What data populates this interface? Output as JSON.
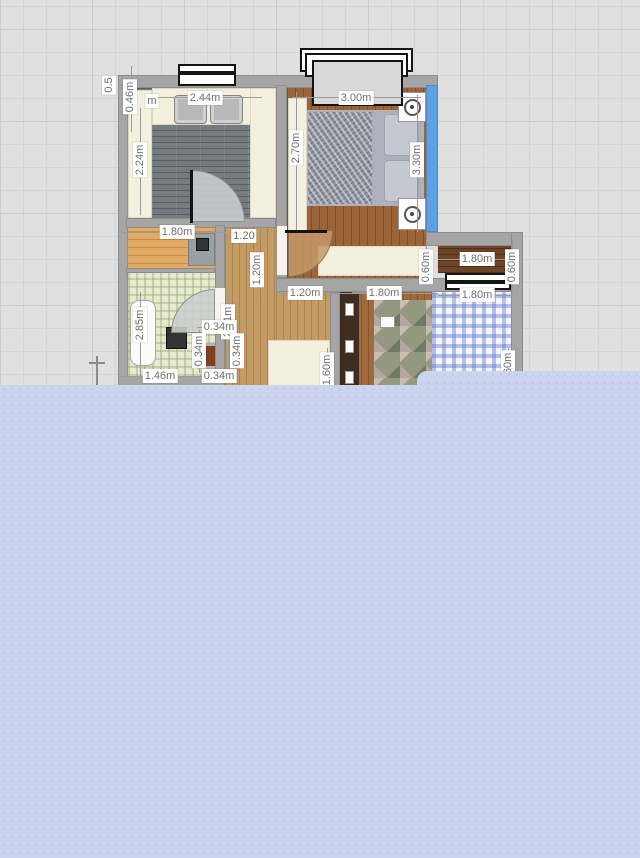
{
  "app": {
    "name": "floor-plan-editor",
    "view": "2d-plan"
  },
  "palette": {
    "canvas_bg": "#e0e0e0",
    "grid_line": "#d4d4d4",
    "grid_major": "#c9cbce",
    "wall": "#a5a5a5",
    "accent_wall_blue": "#5f9fe3",
    "panel": "#cbd5ee",
    "panel_dot": "#c0cae8",
    "dim_text": "#6f6f6f",
    "dim_bg": "#ffffff"
  },
  "panel": {
    "main": {
      "x": 0,
      "y": 385,
      "w": 640,
      "h": 473
    },
    "step": {
      "x": 417,
      "y": 371,
      "w": 223,
      "h": 16
    }
  },
  "plan": {
    "elements": [
      {
        "name": "kitchen-floor",
        "cls": "floor-kitchen",
        "x": 128,
        "y": 88,
        "w": 148,
        "h": 130,
        "ia": 1
      },
      {
        "name": "bedroom-floor",
        "cls": "floor-wood-dark",
        "x": 287,
        "y": 88,
        "w": 139,
        "h": 190,
        "ia": 1
      },
      {
        "name": "hallway-floor",
        "cls": "floor-wood-light",
        "x": 225,
        "y": 228,
        "w": 51,
        "h": 160,
        "ia": 1
      },
      {
        "name": "hallway-floor-lower",
        "cls": "floor-wood-light",
        "x": 276,
        "y": 292,
        "w": 54,
        "h": 96,
        "ia": 1
      },
      {
        "name": "storeroom-floor",
        "cls": "floor-wood-tan",
        "x": 128,
        "y": 228,
        "w": 87,
        "h": 44,
        "ia": 1
      },
      {
        "name": "bathroom-floor",
        "cls": "tile-green",
        "x": 128,
        "y": 272,
        "w": 87,
        "h": 104,
        "ia": 1
      },
      {
        "name": "balcony-floor",
        "cls": "floor-wood-deep",
        "x": 438,
        "y": 246,
        "w": 73,
        "h": 27,
        "ia": 1
      },
      {
        "name": "kids-room-floor",
        "cls": "floor-wood-mid",
        "x": 340,
        "y": 292,
        "w": 171,
        "h": 96,
        "ia": 1
      },
      {
        "name": "kitchen-counter-left",
        "cls": "cream",
        "x": 128,
        "y": 90,
        "w": 24,
        "h": 128,
        "ia": 1
      },
      {
        "name": "kitchen-counter-top",
        "cls": "cream",
        "x": 152,
        "y": 88,
        "w": 124,
        "h": 37,
        "ia": 1
      },
      {
        "name": "kitchen-sink",
        "cls": "sink",
        "x": 174,
        "y": 95,
        "w": 33,
        "h": 29,
        "ia": 1
      },
      {
        "name": "kitchen-sink",
        "cls": "sink",
        "x": 210,
        "y": 95,
        "w": 33,
        "h": 29,
        "ia": 1
      },
      {
        "name": "kitchen-counter-right",
        "cls": "cream",
        "x": 250,
        "y": 88,
        "w": 26,
        "h": 130,
        "ia": 1
      },
      {
        "name": "wardrobe",
        "cls": "cream",
        "x": 288,
        "y": 98,
        "w": 19,
        "h": 134,
        "ia": 1
      },
      {
        "name": "bed-base",
        "cls": "bed-base",
        "x": 307,
        "y": 110,
        "w": 117,
        "h": 96,
        "ia": 1
      },
      {
        "name": "bed-blanket",
        "cls": "blanket-silver",
        "x": 308,
        "y": 112,
        "w": 64,
        "h": 92,
        "ia": 0
      },
      {
        "name": "bed-pillow",
        "cls": "pillow",
        "x": 384,
        "y": 114,
        "w": 35,
        "h": 42,
        "ia": 0
      },
      {
        "name": "bed-pillow",
        "cls": "pillow",
        "x": 384,
        "y": 160,
        "w": 35,
        "h": 42,
        "ia": 0
      },
      {
        "name": "nightstand",
        "cls": "white-box knob",
        "x": 398,
        "y": 92,
        "w": 28,
        "h": 30,
        "ia": 1
      },
      {
        "name": "nightstand",
        "cls": "white-box knob",
        "x": 398,
        "y": 198,
        "w": 28,
        "h": 32,
        "ia": 1
      },
      {
        "name": "dresser",
        "cls": "cream",
        "x": 318,
        "y": 246,
        "w": 108,
        "h": 30,
        "ia": 1
      },
      {
        "name": "desk",
        "cls": "desk-gray",
        "x": 188,
        "y": 233,
        "w": 27,
        "h": 33,
        "ia": 1
      },
      {
        "name": "desk-item",
        "cls": "appliance-dark",
        "x": 196,
        "y": 238,
        "w": 13,
        "h": 13,
        "ia": 0
      },
      {
        "name": "bathtub",
        "cls": "tub",
        "x": 130,
        "y": 300,
        "w": 26,
        "h": 66,
        "ia": 1
      },
      {
        "name": "washing-machine",
        "cls": "appliance-dark",
        "x": 166,
        "y": 327,
        "w": 21,
        "h": 22,
        "ia": 1
      },
      {
        "name": "duct-shaft",
        "cls": "shaft",
        "x": 197,
        "y": 343,
        "w": 26,
        "h": 26,
        "ia": 1
      },
      {
        "name": "wardrobe-dark",
        "cls": "dark-unit",
        "x": 340,
        "y": 292,
        "w": 19,
        "h": 96,
        "ia": 1
      },
      {
        "name": "wardrobe-handle",
        "cls": "white-box",
        "x": 345,
        "y": 303,
        "w": 9,
        "h": 13,
        "ia": 0
      },
      {
        "name": "wardrobe-handle",
        "cls": "white-box",
        "x": 345,
        "y": 340,
        "w": 9,
        "h": 13,
        "ia": 0
      },
      {
        "name": "wardrobe-handle",
        "cls": "white-box",
        "x": 345,
        "y": 371,
        "w": 9,
        "h": 13,
        "ia": 0
      },
      {
        "name": "camo-rug",
        "cls": "camo",
        "x": 374,
        "y": 300,
        "w": 60,
        "h": 88,
        "ia": 1
      },
      {
        "name": "gingham-bed",
        "cls": "gingham-blue",
        "x": 432,
        "y": 292,
        "w": 79,
        "h": 96,
        "ia": 1
      },
      {
        "name": "clutter",
        "cls": "white-box",
        "x": 352,
        "y": 282,
        "w": 26,
        "h": 11,
        "ia": 0
      },
      {
        "name": "clutter",
        "cls": "white-box",
        "x": 380,
        "y": 316,
        "w": 15,
        "h": 12,
        "ia": 0
      },
      {
        "name": "hall-table",
        "cls": "cream",
        "x": 268,
        "y": 340,
        "w": 62,
        "h": 48,
        "ia": 1
      },
      {
        "name": "wall-top",
        "cls": "wall",
        "x": 118,
        "y": 75,
        "w": 320,
        "h": 13,
        "ia": 1
      },
      {
        "name": "wall-left",
        "cls": "wall",
        "x": 118,
        "y": 85,
        "w": 10,
        "h": 303,
        "ia": 1
      },
      {
        "name": "wall-kitchen-right",
        "cls": "wall",
        "x": 276,
        "y": 85,
        "w": 11,
        "h": 193,
        "ia": 1
      },
      {
        "name": "wall-kitchen-bottom",
        "cls": "wall",
        "x": 126,
        "y": 218,
        "w": 150,
        "h": 10,
        "ia": 1
      },
      {
        "name": "wall-bath-sep",
        "cls": "wall",
        "x": 126,
        "y": 268,
        "w": 89,
        "h": 5,
        "ia": 1
      },
      {
        "name": "wall-bath-right",
        "cls": "wall",
        "x": 215,
        "y": 225,
        "w": 10,
        "h": 163,
        "ia": 1
      },
      {
        "name": "wall-bottom-band",
        "cls": "wall",
        "x": 276,
        "y": 278,
        "w": 235,
        "h": 14,
        "ia": 1
      },
      {
        "name": "wall-balcony-top",
        "cls": "wall",
        "x": 426,
        "y": 232,
        "w": 97,
        "h": 14,
        "ia": 1
      },
      {
        "name": "wall-right-outer",
        "cls": "wall",
        "x": 511,
        "y": 232,
        "w": 12,
        "h": 156,
        "ia": 1
      },
      {
        "name": "wall-kids-left",
        "cls": "wall",
        "x": 330,
        "y": 292,
        "w": 10,
        "h": 96,
        "ia": 1
      },
      {
        "name": "wall-bath-bottom",
        "cls": "wall",
        "x": 118,
        "y": 376,
        "w": 107,
        "h": 12,
        "ia": 1
      },
      {
        "name": "wall-accent-blue",
        "cls": "wall-blue",
        "x": 426,
        "y": 85,
        "w": 12,
        "h": 147,
        "ia": 1
      },
      {
        "name": "door-swing",
        "cls": "arc-gray",
        "x": 192,
        "y": 170,
        "w": 53,
        "h": 52,
        "r": "0 100% 0 0",
        "ia": 1
      },
      {
        "name": "door-leaf",
        "cls": "door-line",
        "x": 190,
        "y": 170,
        "w": 3,
        "h": 53,
        "ia": 1
      },
      {
        "name": "door-gap",
        "cls": "gap-white",
        "x": 277,
        "y": 226,
        "w": 10,
        "h": 49,
        "ia": 0
      },
      {
        "name": "door-swing",
        "cls": "arc-tan",
        "x": 288,
        "y": 230,
        "w": 45,
        "h": 47,
        "r": "0 0 100% 0",
        "ia": 1
      },
      {
        "name": "door-leaf",
        "cls": "door-line",
        "x": 285,
        "y": 230,
        "w": 42,
        "h": 3,
        "ia": 1
      },
      {
        "name": "door-gap",
        "cls": "gap-white",
        "x": 215,
        "y": 288,
        "w": 10,
        "h": 45,
        "ia": 0
      },
      {
        "name": "door-swing",
        "cls": "arc-gray",
        "x": 171,
        "y": 289,
        "w": 44,
        "h": 44,
        "r": "100% 0 0 0",
        "ia": 1
      },
      {
        "name": "window",
        "cls": "win-bar",
        "x": 178,
        "y": 64,
        "w": 58,
        "h": 9,
        "ia": 1
      },
      {
        "name": "window",
        "cls": "win-bar",
        "x": 178,
        "y": 73,
        "w": 58,
        "h": 13,
        "ia": 1
      },
      {
        "name": "sliding-window-outer",
        "cls": "win-bar",
        "x": 300,
        "y": 48,
        "w": 113,
        "h": 24,
        "ia": 1
      },
      {
        "name": "sliding-window-mid",
        "cls": "win-bar",
        "x": 305,
        "y": 53,
        "w": 103,
        "h": 24,
        "ia": 1
      },
      {
        "name": "sliding-window-glass",
        "cls": "win-glass",
        "x": 312,
        "y": 60,
        "w": 91,
        "h": 46,
        "ia": 1
      },
      {
        "name": "window",
        "cls": "win-bar",
        "x": 445,
        "y": 273,
        "w": 66,
        "h": 9,
        "ia": 1
      },
      {
        "name": "window",
        "cls": "win-bar",
        "x": 445,
        "y": 282,
        "w": 66,
        "h": 8,
        "ia": 1
      },
      {
        "name": "origin-marker",
        "cls": "mark",
        "x": 96,
        "y": 356,
        "w": 2,
        "h": 32,
        "ia": 0
      },
      {
        "name": "origin-marker-cross",
        "cls": "mark",
        "x": 89,
        "y": 362,
        "w": 16,
        "h": 2,
        "ia": 0
      }
    ],
    "dim_lines": [
      {
        "x": 150,
        "y": 97,
        "w": 112,
        "h": 1
      },
      {
        "x": 292,
        "y": 97,
        "w": 129,
        "h": 1
      },
      {
        "x": 140,
        "y": 108,
        "w": 1,
        "h": 107
      },
      {
        "x": 296,
        "y": 92,
        "w": 1,
        "h": 138
      },
      {
        "x": 417,
        "y": 95,
        "w": 1,
        "h": 137
      },
      {
        "x": 131,
        "y": 66,
        "w": 1,
        "h": 66
      },
      {
        "x": 122,
        "y": 232,
        "w": 104,
        "h": 1
      },
      {
        "x": 226,
        "y": 236,
        "w": 42,
        "h": 1
      },
      {
        "x": 257,
        "y": 240,
        "w": 1,
        "h": 60
      },
      {
        "x": 228,
        "y": 292,
        "w": 1,
        "h": 84
      },
      {
        "x": 140,
        "y": 292,
        "w": 1,
        "h": 86
      },
      {
        "x": 276,
        "y": 293,
        "w": 56,
        "h": 1
      },
      {
        "x": 332,
        "y": 293,
        "w": 106,
        "h": 1
      },
      {
        "x": 426,
        "y": 240,
        "w": 1,
        "h": 52
      },
      {
        "x": 438,
        "y": 259,
        "w": 74,
        "h": 1
      },
      {
        "x": 512,
        "y": 240,
        "w": 1,
        "h": 54
      },
      {
        "x": 438,
        "y": 295,
        "w": 74,
        "h": 1
      },
      {
        "x": 197,
        "y": 327,
        "w": 44,
        "h": 1
      },
      {
        "x": 199,
        "y": 330,
        "w": 1,
        "h": 43
      },
      {
        "x": 237,
        "y": 330,
        "w": 1,
        "h": 43
      },
      {
        "x": 197,
        "y": 376,
        "w": 44,
        "h": 1
      },
      {
        "x": 118,
        "y": 376,
        "w": 79,
        "h": 1
      },
      {
        "x": 327,
        "y": 348,
        "w": 1,
        "h": 38
      },
      {
        "x": 508,
        "y": 348,
        "w": 1,
        "h": 38
      }
    ],
    "labels": [
      {
        "t": "0.5",
        "x": 109,
        "y": 85,
        "rot": 1
      },
      {
        "t": "0.46m",
        "x": 130,
        "y": 97,
        "rot": 1
      },
      {
        "t": "m",
        "x": 152,
        "y": 101,
        "rot": 0
      },
      {
        "t": "2.44m",
        "x": 205,
        "y": 98,
        "rot": 0
      },
      {
        "t": "3.00m",
        "x": 356,
        "y": 98,
        "rot": 0
      },
      {
        "t": "2.24m",
        "x": 140,
        "y": 160,
        "rot": 1
      },
      {
        "t": "2.70m",
        "x": 296,
        "y": 148,
        "rot": 1
      },
      {
        "t": "3.30m",
        "x": 417,
        "y": 160,
        "rot": 1
      },
      {
        "t": "1.80m",
        "x": 177,
        "y": 232,
        "rot": 0
      },
      {
        "t": "1.20",
        "x": 244,
        "y": 236,
        "rot": 0
      },
      {
        "t": "1.20m",
        "x": 257,
        "y": 270,
        "rot": 1
      },
      {
        "t": "2.51m",
        "x": 228,
        "y": 322,
        "rot": 1
      },
      {
        "t": "2.85m",
        "x": 140,
        "y": 325,
        "rot": 1
      },
      {
        "t": "1.20m",
        "x": 305,
        "y": 293,
        "rot": 0
      },
      {
        "t": "1.80m",
        "x": 384,
        "y": 293,
        "rot": 0
      },
      {
        "t": "0.60m",
        "x": 426,
        "y": 267,
        "rot": 1
      },
      {
        "t": "1.80m",
        "x": 477,
        "y": 259,
        "rot": 0
      },
      {
        "t": "0.60m",
        "x": 512,
        "y": 267,
        "rot": 1
      },
      {
        "t": "1.80m",
        "x": 477,
        "y": 295,
        "rot": 0
      },
      {
        "t": "0.34m",
        "x": 219,
        "y": 327,
        "rot": 0
      },
      {
        "t": "0.34m",
        "x": 199,
        "y": 351,
        "rot": 1
      },
      {
        "t": "0.34m",
        "x": 237,
        "y": 351,
        "rot": 1
      },
      {
        "t": "0.34m",
        "x": 219,
        "y": 376,
        "rot": 0
      },
      {
        "t": "1.46m",
        "x": 160,
        "y": 376,
        "rot": 0
      },
      {
        "t": "1.60m",
        "x": 327,
        "y": 370,
        "rot": 1
      },
      {
        "t": "1.60m",
        "x": 508,
        "y": 368,
        "rot": 1
      }
    ]
  }
}
